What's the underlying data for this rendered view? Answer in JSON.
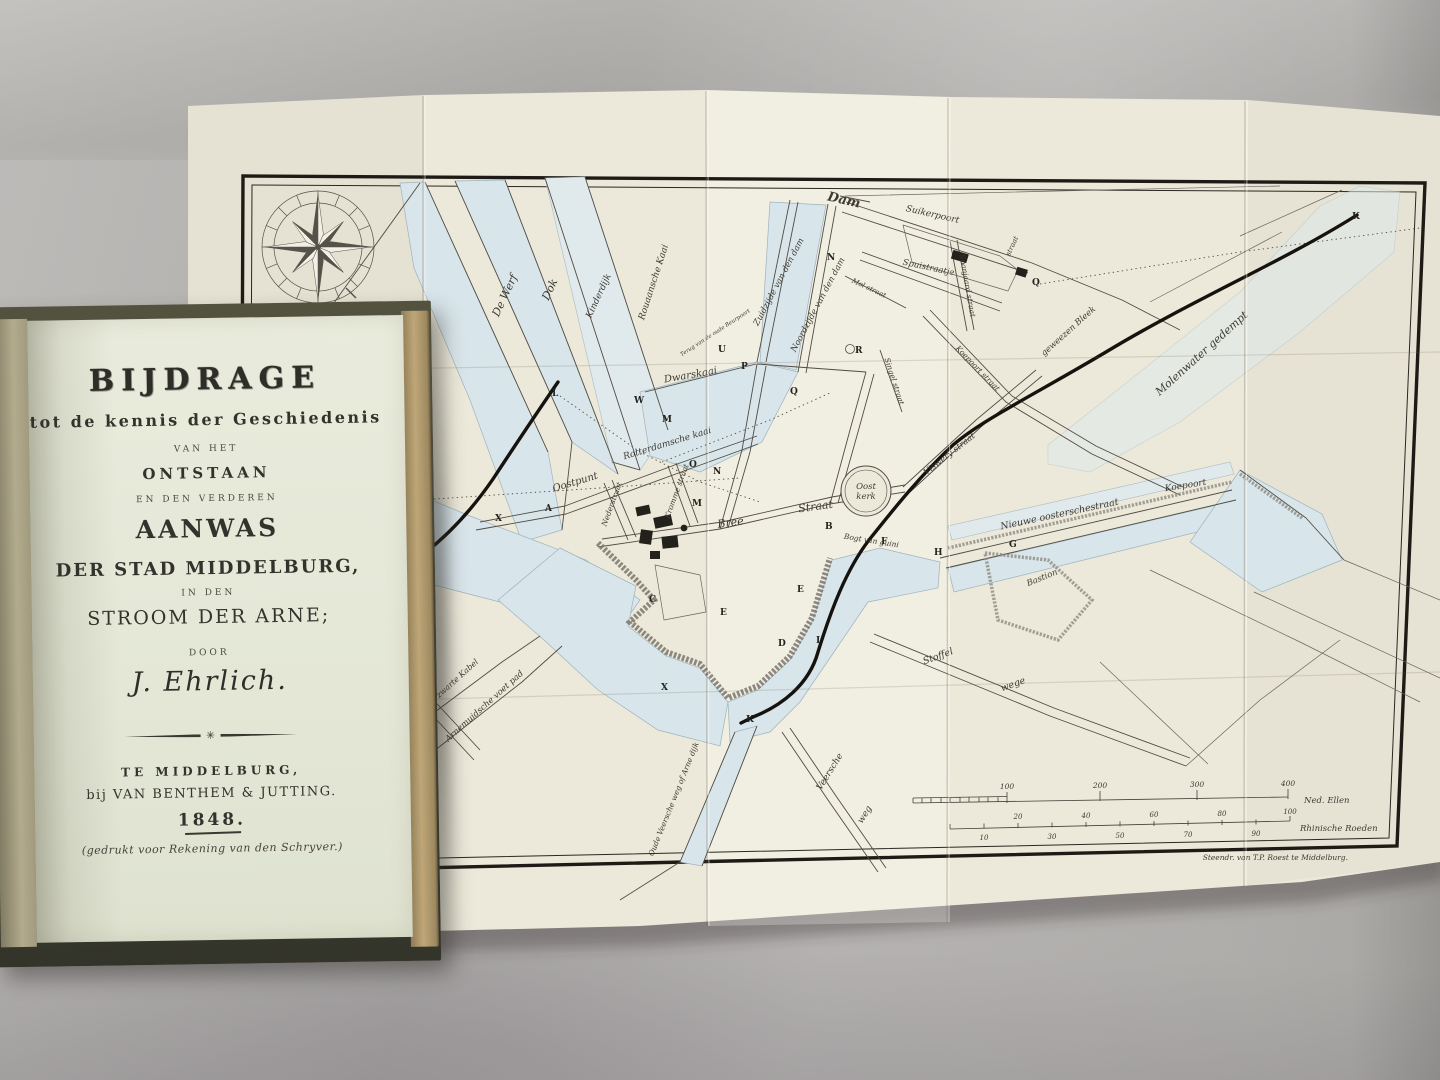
{
  "book": {
    "title_main": "BIJDRAGE",
    "subtitle": "tot de kennis der Geschiedenis",
    "van_het": "VAN HET",
    "ontstaan": "ONTSTAAN",
    "en_den_verderen": "EN DEN VERDEREN",
    "aanwas": "AANWAS",
    "der_stad": "DER STAD MIDDELBURG,",
    "in_den": "IN DEN",
    "stroom": "STROOM DER ARNE;",
    "door": "DOOR",
    "author": "J. Ehrlich.",
    "place": "TE MIDDELBURG,",
    "publisher": "bij VAN BENTHEM & JUTTING.",
    "year": "1848.",
    "note": "(gedrukt voor Rekening van den Schryver.)"
  },
  "map": {
    "labels": {
      "dam": "Dam",
      "suikerpoort": "Suikerpoort",
      "spuistraatje": "Spuistraatje",
      "zuidzijde": "Zuidzijde van den dam",
      "noordzijde": "Noordzijde van den dam",
      "rouaansche_kaai": "Rouaansche Kaai",
      "beurpoort": "Terug van de oude Beurpoort",
      "dwarskaai": "Dwarskaai",
      "de_werf": "De Werf",
      "dok": "Dok",
      "kinderdijk": "Kinderdijk",
      "rotterdamsche_kaai": "Rotterdamsche kaai",
      "oostpunt": "Oostpunt",
      "nederstraat": "Nederstraat",
      "krommestraat": "Kromme straat",
      "bree": "Bree",
      "bree2": "Straat",
      "viswery": "Viswery straat",
      "nieuwe_oosterschestraat": "Nieuwe oosterschestraat",
      "koepoort": "Koepoort",
      "koepoortstraat": "Koepoort straat",
      "bastion": "Bastion",
      "bogt": "Bogt van guini",
      "stoffel": "Stoffel",
      "stoffel2": "wege",
      "veersche": "Veersche",
      "veersche2": "weg",
      "arne_dijk": "Oude Veersche weg of Arne dijk",
      "arnemuidsche": "Arnemuidsche voet pad",
      "zwarte_kabel": "Laan de zwarte Kabel",
      "molenwater": "Molenwater gedempt",
      "bleek": "geweezen Bleek",
      "spanjaard": "Spanjaard straat",
      "singel": "Singel straat",
      "mol": "Mol straat",
      "straat_ne": "straat"
    },
    "oostkerk": {
      "line1": "Oost",
      "line2": "kerk"
    },
    "letters": [
      "A",
      "B",
      "C",
      "D",
      "E",
      "E",
      "F",
      "G",
      "H",
      "I",
      "K",
      "K",
      "L",
      "M",
      "M",
      "N",
      "N",
      "O",
      "P",
      "Q",
      "Q",
      "R",
      "U",
      "W",
      "X",
      "X"
    ],
    "scale1": {
      "ticks": [
        "100",
        "200",
        "300",
        "400"
      ],
      "unit": "Ned. Ellen"
    },
    "scale2": {
      "ticks_top": [
        "20",
        "40",
        "60",
        "80",
        "100"
      ],
      "ticks_bottom": [
        "10",
        "30",
        "50",
        "70",
        "90"
      ],
      "unit": "Rhinische Roeden"
    },
    "credit": "Steendr. van T.P. Roest te Middelburg."
  }
}
